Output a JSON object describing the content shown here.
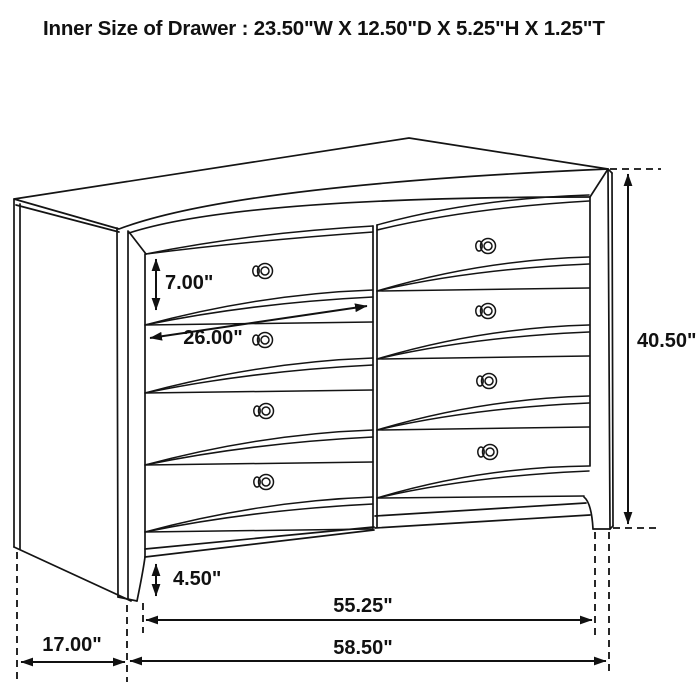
{
  "title": "Inner Size of Drawer : 23.50\"W X 12.50\"D X 5.25\"H X 1.25\"T",
  "diagram": {
    "subject": "Eight-drawer dresser technical line drawing with dimension arrows",
    "background_color": "#ffffff",
    "line_color": "#141414",
    "drawer_rows": 4,
    "drawer_columns": 2,
    "labels": {
      "drawer_front_height": "7.00\"",
      "drawer_inner_width": "26.00\"",
      "overall_height": "40.50\"",
      "foot_height": "4.50\"",
      "base_width": "55.25\"",
      "depth": "17.00\"",
      "overall_width": "58.50\""
    }
  }
}
